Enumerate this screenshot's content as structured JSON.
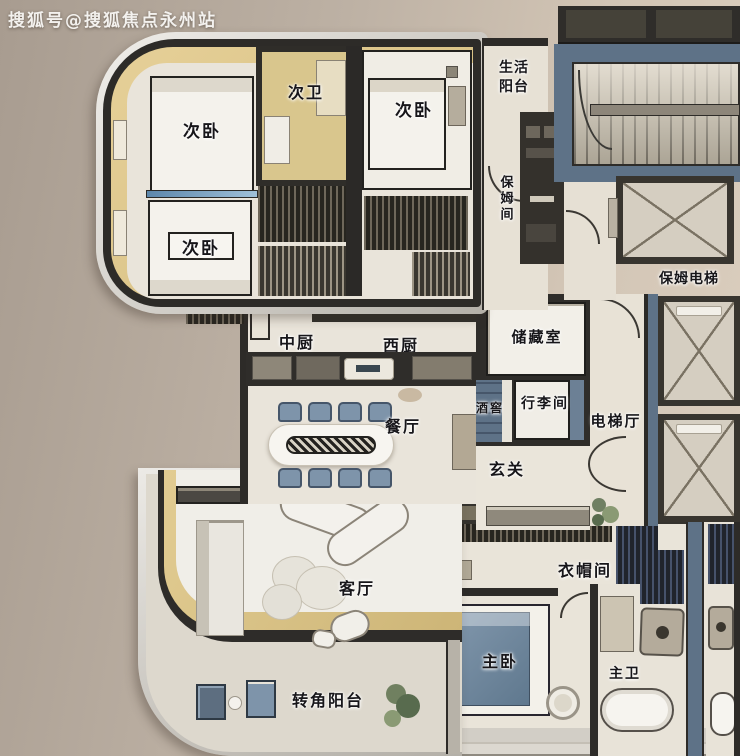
{
  "watermark": "搜狐号@搜狐焦点永州站",
  "palette": {
    "background_left": "#a89c90",
    "background_right": "#dccfbf",
    "wall_dark": "#2d2b28",
    "wall_blue": "#5e7287",
    "gold_band": "#ddc78c",
    "floor_cream": "#e9e4da",
    "floor_bright": "#f0eee8",
    "furniture_blue": "#7e94aa",
    "chrome_edge": "#d9d6d1",
    "plant_green": "#6f7f62"
  },
  "rooms": {
    "bedroom2_top": {
      "label": "次卧"
    },
    "bath2": {
      "label": "次卫"
    },
    "bedroom2_bottom": {
      "label": "次卧"
    },
    "bedroom2_right": {
      "label": "次卧"
    },
    "life_balcony": {
      "label": "生活阳台"
    },
    "nanny_room": {
      "label": "保姆间"
    },
    "public_bath": {
      "label": "公卫"
    },
    "nanny_elevator": {
      "label": "保姆电梯"
    },
    "chinese_kitchen": {
      "label": "中厨"
    },
    "western_kitchen": {
      "label": "西厨"
    },
    "storage": {
      "label": "储藏室"
    },
    "wine_cellar": {
      "label": "酒窖"
    },
    "luggage": {
      "label": "行李间"
    },
    "elevator_hall": {
      "label": "电梯厅"
    },
    "dining": {
      "label": "餐厅"
    },
    "foyer": {
      "label": "玄关"
    },
    "living": {
      "label": "客厅"
    },
    "cloakroom": {
      "label": "衣帽间"
    },
    "master_bedroom": {
      "label": "主卧"
    },
    "master_bath": {
      "label": "主卫"
    },
    "corner_balcony": {
      "label": "转角阳台"
    }
  }
}
